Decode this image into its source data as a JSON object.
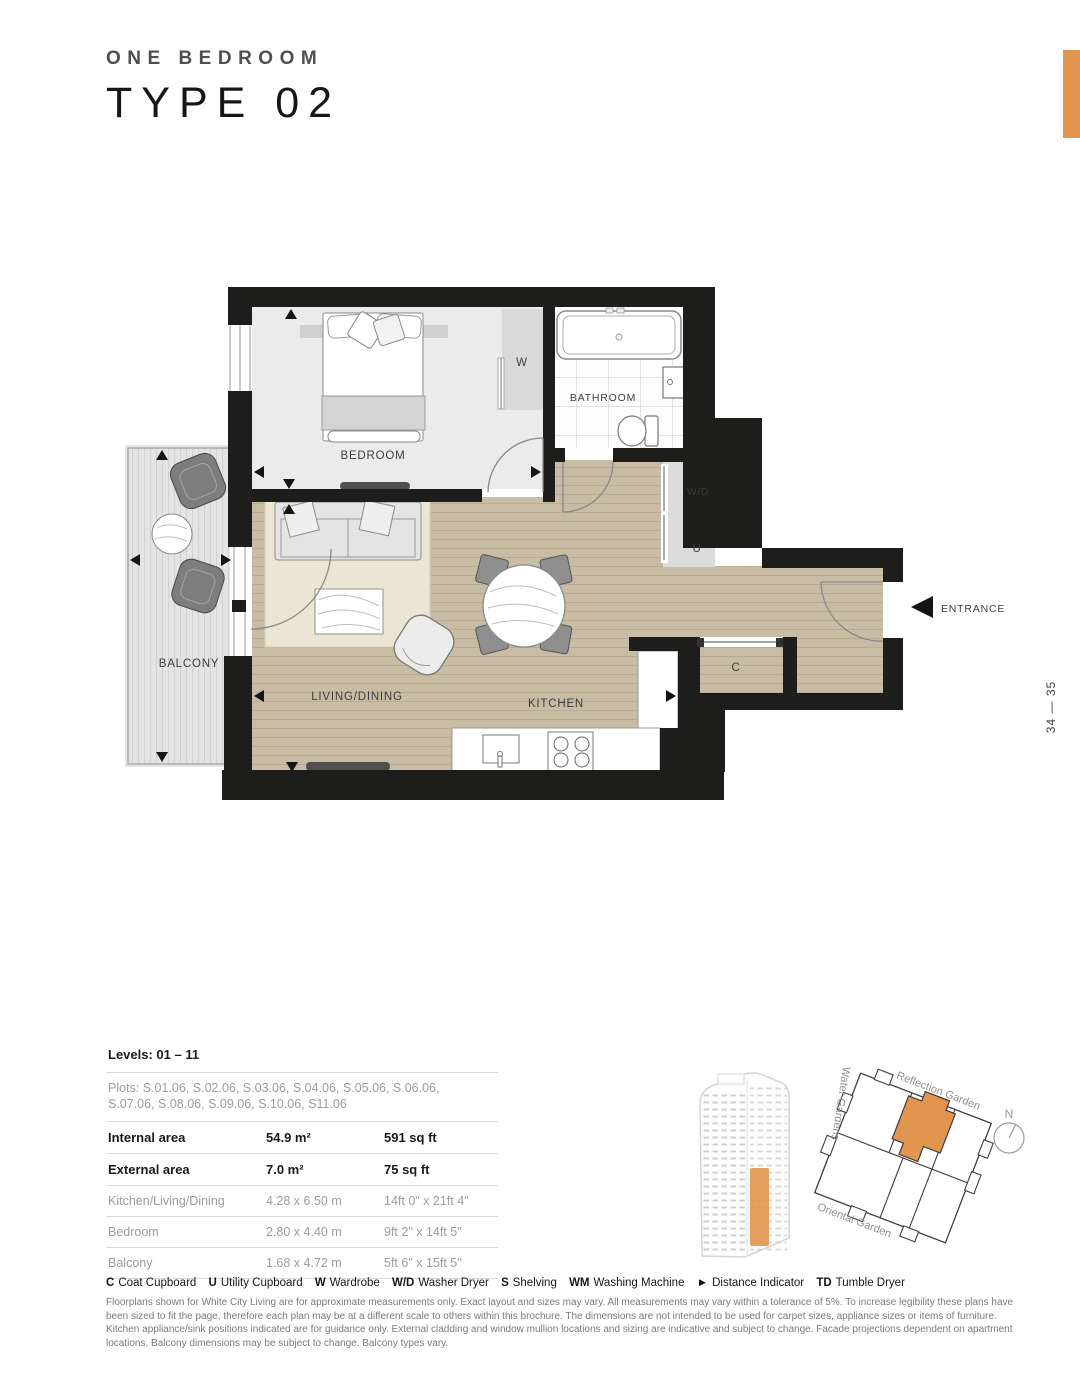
{
  "page": {
    "title_line1": "ONE BEDROOM",
    "title_line2": "TYPE 02",
    "page_number": "34 — 35",
    "accent_color": "#E2954E",
    "wall_color": "#1D1D1B",
    "floor_color": "#C8BCA4"
  },
  "plan": {
    "labels": {
      "bedroom": "BEDROOM",
      "bathroom": "BATHROOM",
      "balcony": "BALCONY",
      "living_dining": "LIVING/DINING",
      "kitchen": "KITCHEN",
      "wardrobe": "W",
      "washer_dryer": "W/D",
      "utility": "U",
      "coat": "C",
      "entrance": "ENTRANCE"
    }
  },
  "site": {
    "reflection": "Reflection Garden",
    "water": "Water Gardens",
    "oriental": "Oriental Garden",
    "north": "N"
  },
  "spec": {
    "levels": "Levels: 01 – 11",
    "plots_line1": "Plots: S.01.06, S.02.06, S.03.06, S.04.06, S.05.06, S.06.06,",
    "plots_line2": "S.07.06, S.08.06, S.09.06, S.10.06, S11.06",
    "rows": [
      {
        "label": "Internal area",
        "metric": "54.9 m²",
        "imperial": "591 sq ft"
      },
      {
        "label": "External area",
        "metric": "7.0 m²",
        "imperial": "75 sq ft"
      },
      {
        "label": "Kitchen/Living/Dining",
        "metric": "4.28 x 6.50 m",
        "imperial": "14ft 0\" x 21ft 4\""
      },
      {
        "label": "Bedroom",
        "metric": "2.80 x 4.40 m",
        "imperial": "9ft 2\" x 14ft 5\""
      },
      {
        "label": "Balcony",
        "metric": "1.68 x 4.72 m",
        "imperial": "5ft 6\" x 15ft 5\""
      }
    ]
  },
  "legend": {
    "items": [
      {
        "key": "C",
        "label": "Coat Cupboard"
      },
      {
        "key": "U",
        "label": "Utility Cupboard"
      },
      {
        "key": "W",
        "label": "Wardrobe"
      },
      {
        "key": "W/D",
        "label": "Washer Dryer"
      },
      {
        "key": "S",
        "label": "Shelving"
      },
      {
        "key": "WM",
        "label": "Washing Machine"
      },
      {
        "key": "►",
        "label": "Distance Indicator"
      },
      {
        "key": "TD",
        "label": "Tumble Dryer"
      }
    ]
  },
  "disclaimer": {
    "line1": "Floorplans shown for White City Living are for approximate measurements only.  Exact layout and sizes may vary. All measurements may vary within a tolerance of 5%. To increase legibility these plans have",
    "line2": "been sized to fit the page, therefore each plan may be at a different scale to others within this brochure. The dimensions are not intended to be used for carpet sizes, appliance sizes or items of furniture.",
    "line3": "Kitchen appliance/sink positions indicated are for guidance only. External cladding and window mullion locations and sizing are indicative and subject to change. Facade projections dependent on apartment",
    "line4": "locations. Balcony dimensions may be subject to change. Balcony types vary."
  }
}
